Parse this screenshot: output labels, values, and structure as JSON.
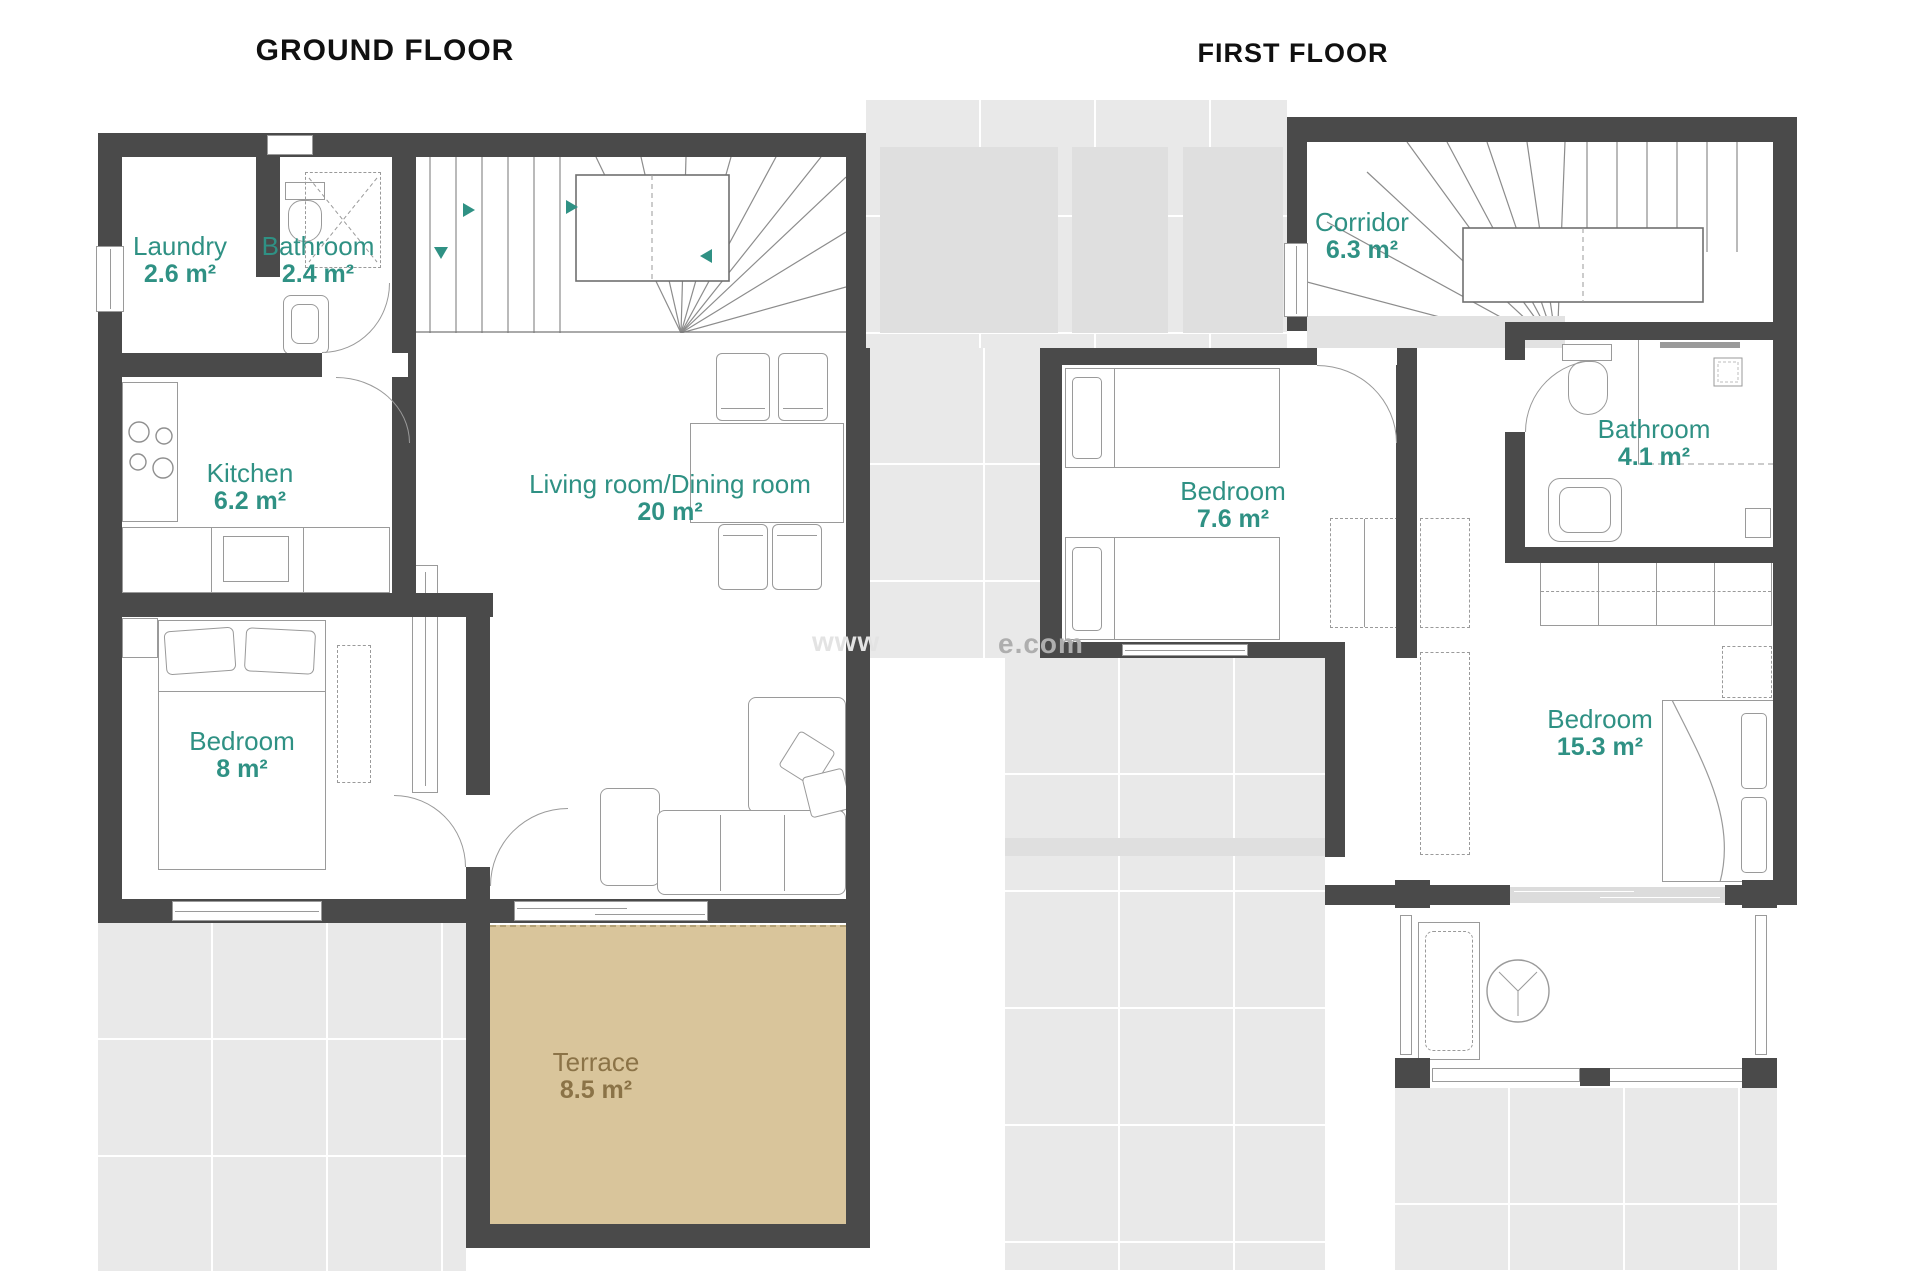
{
  "ground_floor": {
    "title": "GROUND FLOOR",
    "rooms": {
      "laundry": {
        "name": "Laundry",
        "area": "2.6 m²"
      },
      "bathroom": {
        "name": "Bathroom",
        "area": "2.4 m²"
      },
      "kitchen": {
        "name": "Kitchen",
        "area": "6.2 m²"
      },
      "living_dining": {
        "name": "Living room/Dining room",
        "area": "20 m²"
      },
      "bedroom": {
        "name": "Bedroom",
        "area": "8 m²"
      },
      "terrace": {
        "name": "Terrace",
        "area": "8.5 m²"
      }
    }
  },
  "first_floor": {
    "title": "FIRST FLOOR",
    "rooms": {
      "corridor": {
        "name": "Corridor",
        "area": "6.3 m²"
      },
      "bedroom_1": {
        "name": "Bedroom",
        "area": "7.6 m²"
      },
      "bathroom": {
        "name": "Bathroom",
        "area": "4.1 m²"
      },
      "bedroom_2": {
        "name": "Bedroom",
        "area": "15.3 m²"
      }
    }
  },
  "watermark": {
    "visible_left": "www",
    "visible_right": "e.com"
  },
  "colors": {
    "wall": "#4a4a4a",
    "room_label": "#2f9184",
    "terrace_fill": "#d9c59b",
    "terrace_label": "#8b7347",
    "outdoor_gray": "#e9e9e9",
    "furniture_line": "#9a9a9a"
  }
}
